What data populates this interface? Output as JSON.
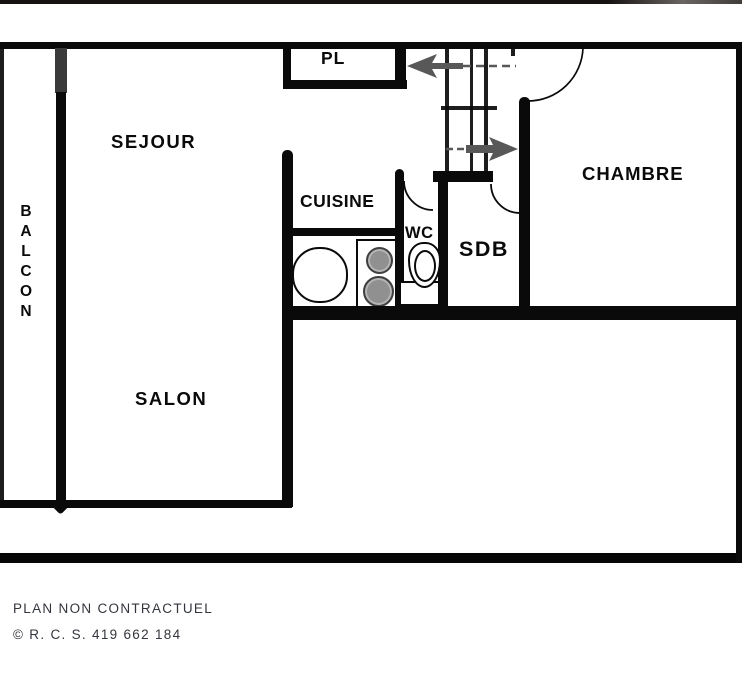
{
  "plan": {
    "rooms": {
      "sejour": {
        "label": "SEJOUR"
      },
      "balcon": {
        "label": "B\nA\nL\nC\nO\nN"
      },
      "cuisine": {
        "label": "CUISINE"
      },
      "closet": {
        "label": "PL"
      },
      "wc": {
        "label": "WC"
      },
      "sdb": {
        "label": "SDB"
      },
      "chambre": {
        "label": "CHAMBRE"
      },
      "salon": {
        "label": "SALON"
      }
    },
    "fixtures": {
      "sink": "kitchen-sink",
      "cooktop": "cooktop-two-burners",
      "toilet": "toilet"
    },
    "entry_arrows": [
      "left",
      "right"
    ]
  },
  "footer": {
    "line1": "PLAN NON CONTRACTUEL",
    "line2": "© R. C. S. 419 662 184"
  },
  "colors": {
    "wall": "#0a0a0a",
    "window_wall": "#3a3a3a",
    "arrow": "#585858",
    "label": "#0a0a0a",
    "footer_text": "#33363d",
    "background": "#ffffff"
  }
}
